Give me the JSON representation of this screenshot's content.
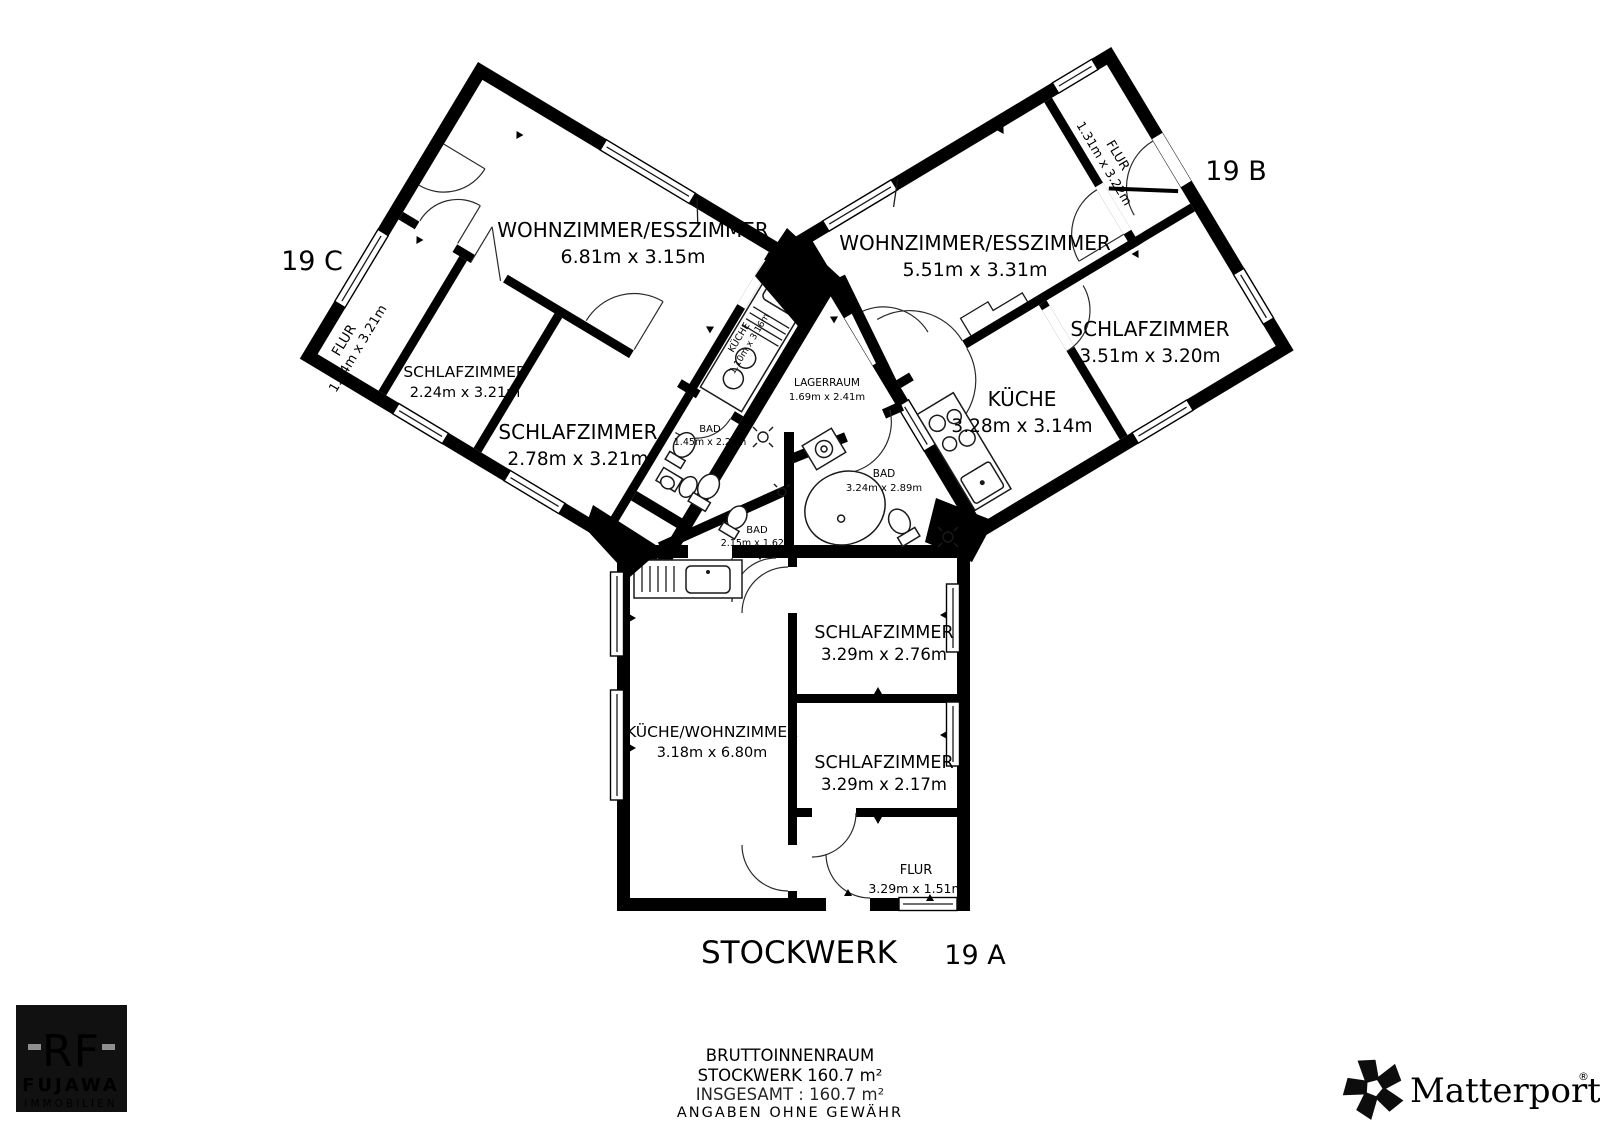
{
  "floor": {
    "title": "STOCKWERK"
  },
  "units": {
    "a": {
      "label": "19 A"
    },
    "b": {
      "label": "19 B"
    },
    "c": {
      "label": "19 C"
    }
  },
  "rooms": {
    "c_living": {
      "name": "WOHNZIMMER/ESSZIMMER",
      "dims": "6.81m x 3.15m"
    },
    "c_flur": {
      "name": "FLUR",
      "dims": "1.44m x 3.21m"
    },
    "c_bed1": {
      "name": "SCHLAFZIMMER",
      "dims": "2.24m x 3.21m"
    },
    "c_bed2": {
      "name": "SCHLAFZIMMER",
      "dims": "2.78m x 3.21m"
    },
    "c_kitchen": {
      "name": "KÜCHE",
      "dims": "1.10m x 3.16m"
    },
    "c_bath": {
      "name": "BAD",
      "dims": "1.45m x 2.25m"
    },
    "storage": {
      "name": "LAGERRAUM",
      "dims": "1.69m x 2.41m"
    },
    "b_bath": {
      "name": "BAD",
      "dims": "3.24m x 2.89m"
    },
    "a_bath": {
      "name": "BAD",
      "dims": "2.15m x 1.62m"
    },
    "b_living": {
      "name": "WOHNZIMMER/ESSZIMMER",
      "dims": "5.51m x 3.31m"
    },
    "b_flur": {
      "name": "FLUR",
      "dims": "1.31m x 3.22m"
    },
    "b_bed": {
      "name": "SCHLAFZIMMER",
      "dims": "3.51m x 3.20m"
    },
    "b_kitchen": {
      "name": "KÜCHE",
      "dims": "3.28m x 3.14m"
    },
    "a_bed1": {
      "name": "SCHLAFZIMMER",
      "dims": "3.29m x 2.76m"
    },
    "a_bed2": {
      "name": "SCHLAFZIMMER",
      "dims": "3.29m x 2.17m"
    },
    "a_kitliv": {
      "name": "KÜCHE/WOHNZIMMER",
      "dims": "3.18m x 6.80m"
    },
    "a_flur": {
      "name": "FLUR",
      "dims": "3.29m x 1.51m"
    }
  },
  "footer": {
    "line1": "BRUTTOINNENRAUM",
    "line2": "STOCKWERK 160.7 m²",
    "line3": "INSGESAMT : 160.7 m²",
    "line4": "ANGABEN OHNE GEWÄHR"
  },
  "branding": {
    "agency": {
      "monogram": "RF",
      "name": "FUJAWA",
      "subtitle": "IMMOBILIEN"
    },
    "matterport": {
      "name": "Matterport",
      "registered": "®"
    }
  },
  "colors": {
    "accent": "#e04430",
    "wall": "#000000",
    "background": "#ffffff"
  }
}
